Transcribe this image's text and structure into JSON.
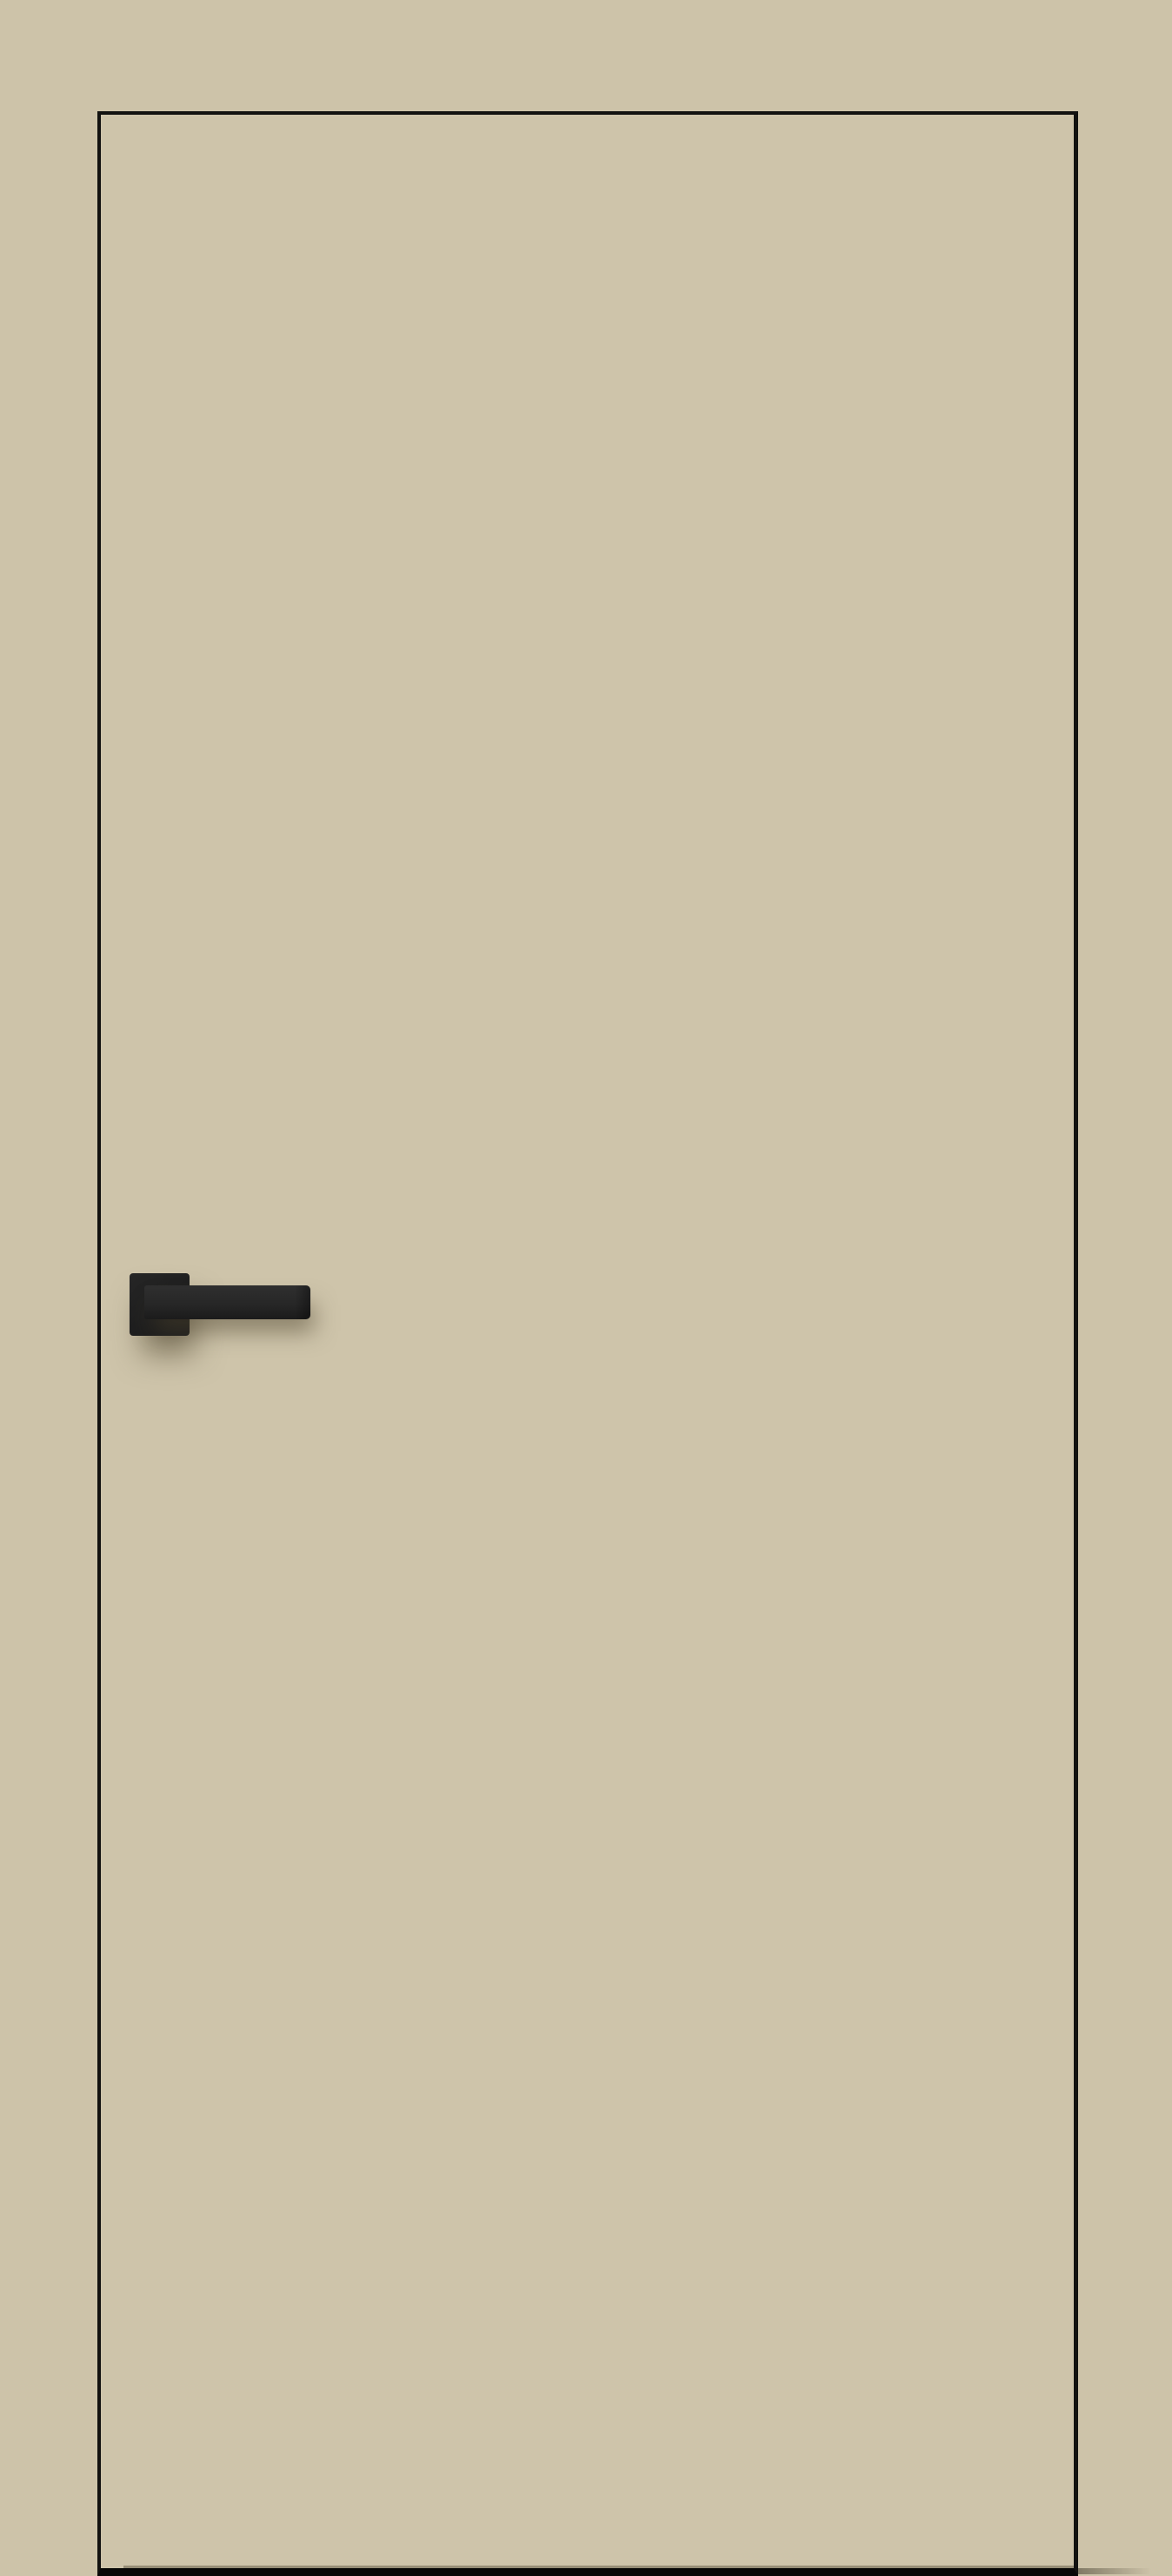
{
  "scene": {
    "subject": "Beige flush interior door with black edge trim and matte-black square-rosette lever handle on a matching beige backdrop; no visible text",
    "colors": {
      "background": "#cdc3a9",
      "door_face": "#cec4aa",
      "edge_trim": "#121210",
      "bottom_edge": "#070706",
      "rosette_dark": "#1d1d1d",
      "rosette_mid": "#262626",
      "lever_top": "#2f2f2f",
      "lever_mid": "#272727",
      "lever_bottom": "#1b1b1b",
      "shadow": "rgba(76,67,46,0.55)"
    }
  }
}
